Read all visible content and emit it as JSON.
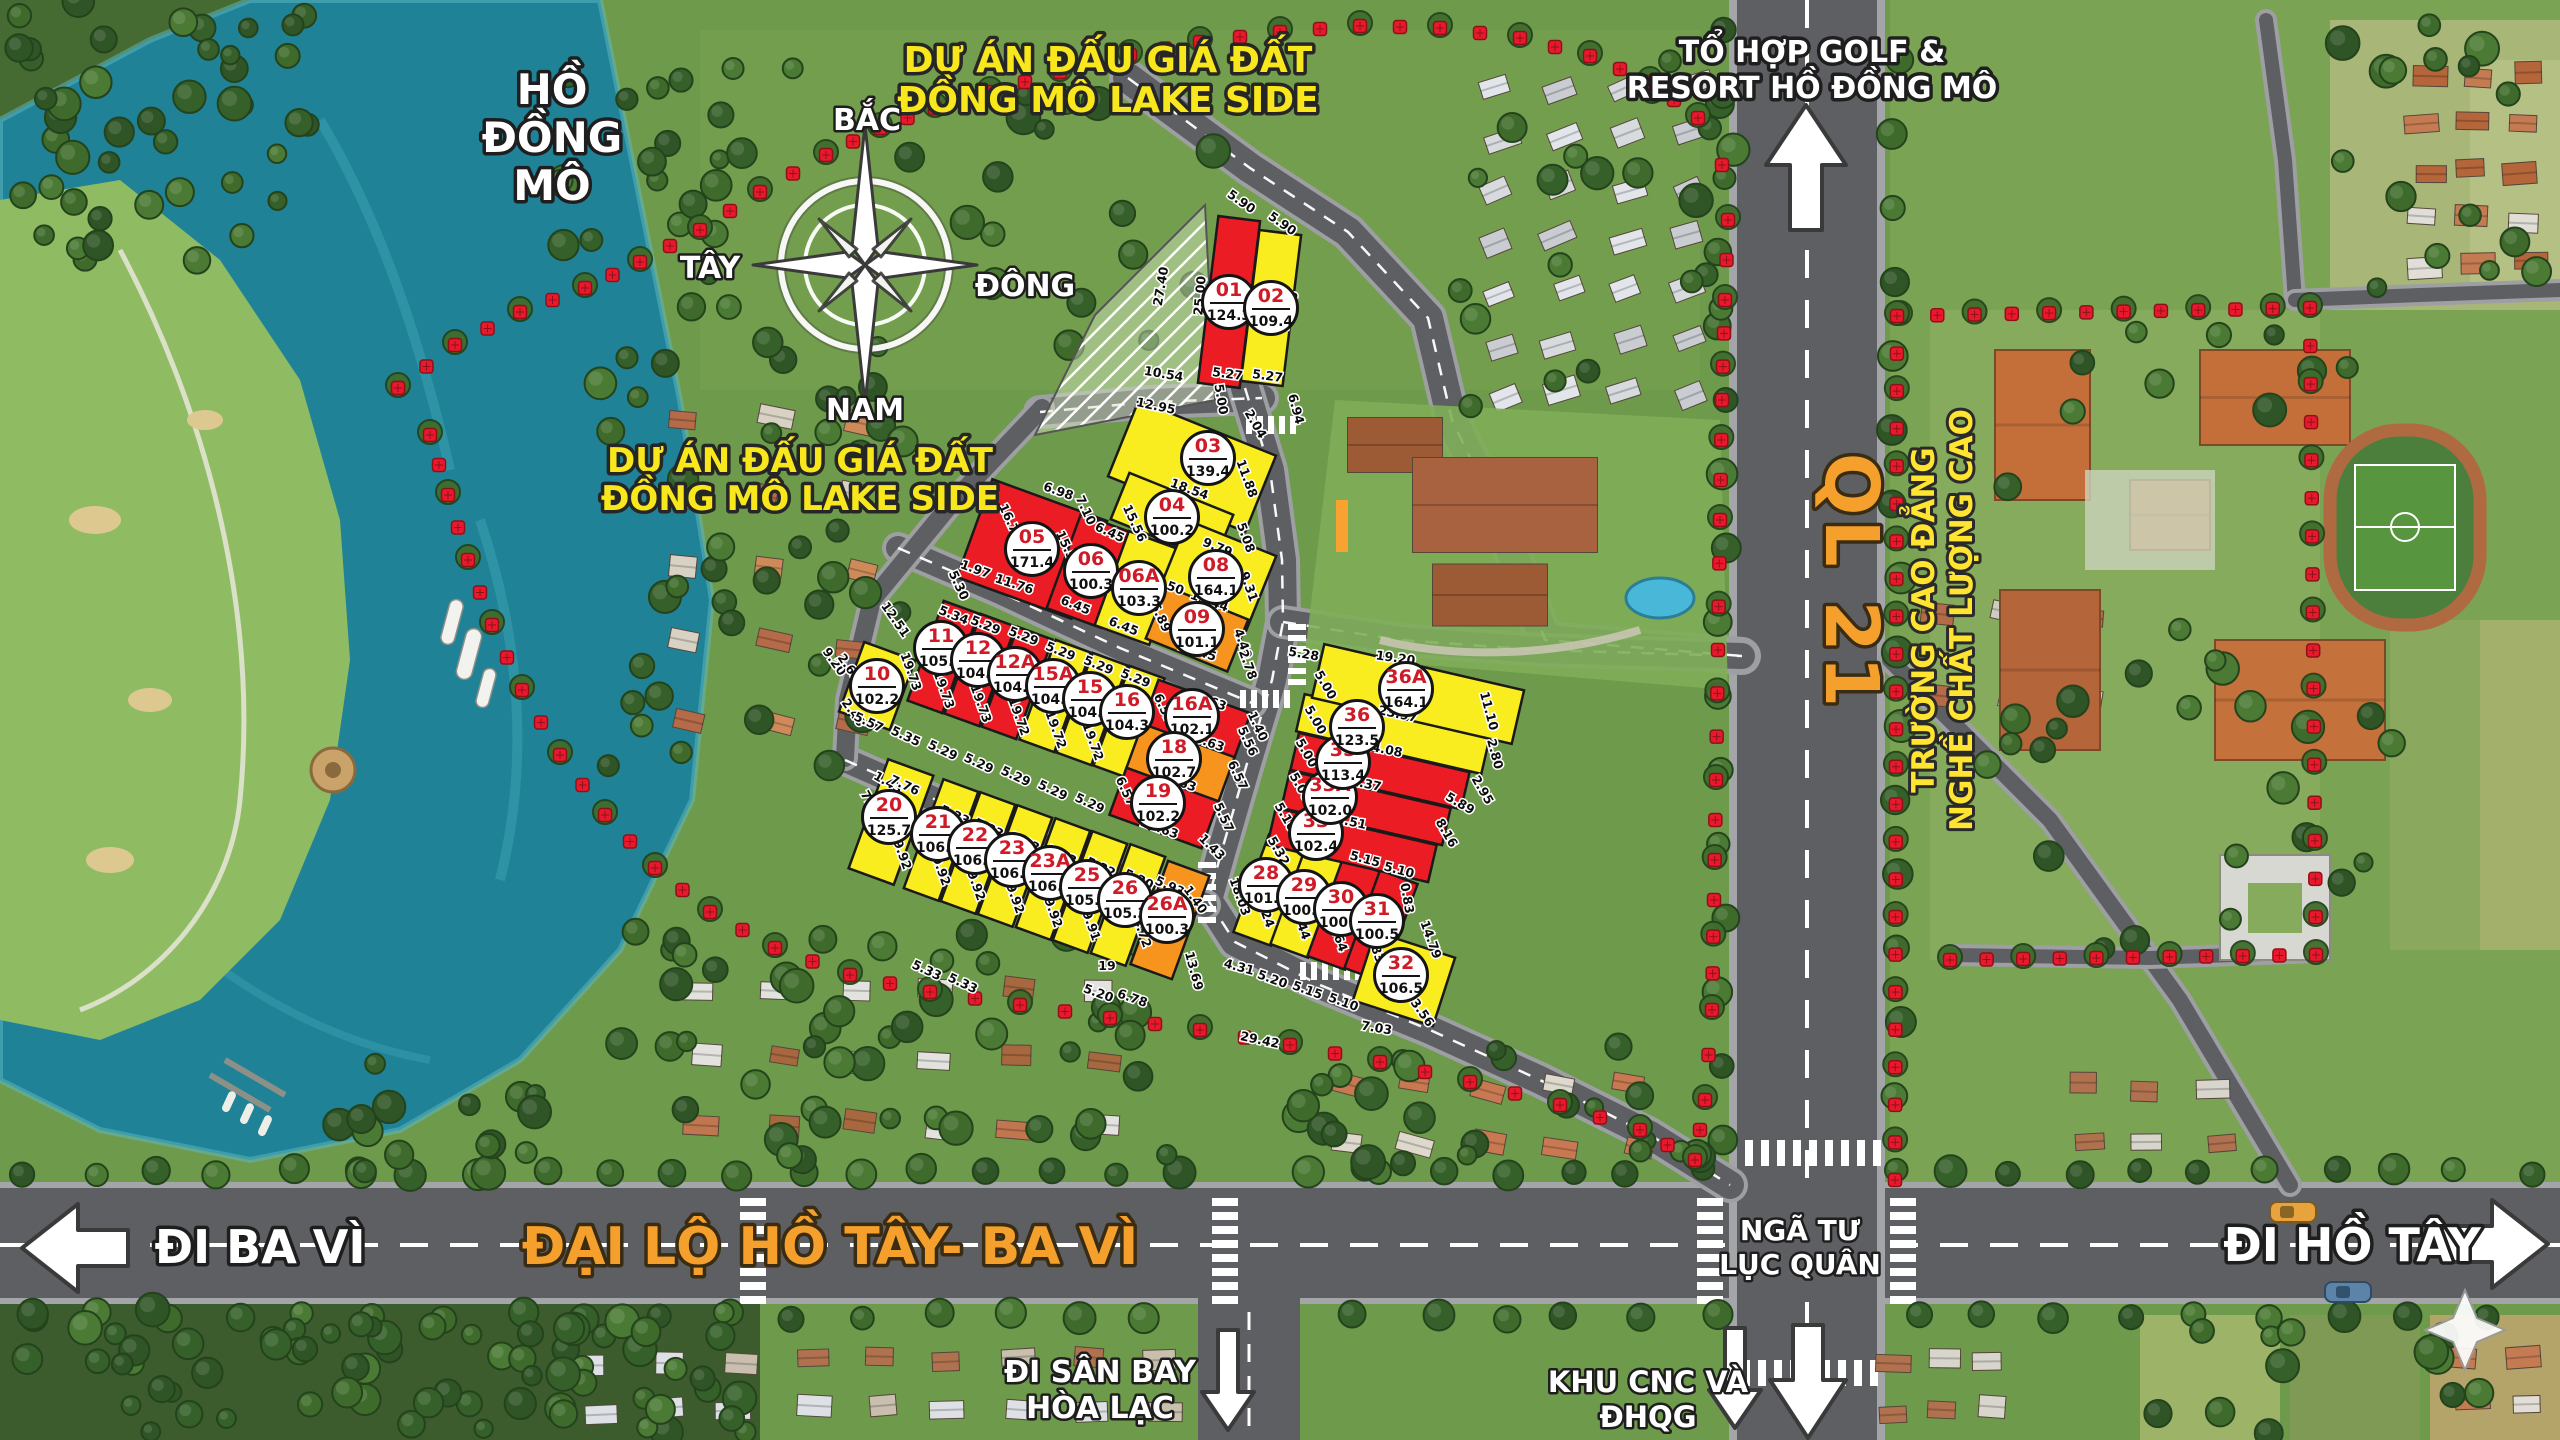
{
  "map": {
    "lake_name_l1": "HỒ",
    "lake_name_l2": "ĐỒNG",
    "lake_name_l3": "MÔ",
    "project_boundary_label_top_l1": "DỰ ÁN ĐẤU GIÁ ĐẤT",
    "project_boundary_label_top_l2": "ĐỒNG MÔ LAKE SIDE",
    "project_boundary_label_left_l1": "DỰ ÁN ĐẤU GIÁ ĐẤT",
    "project_boundary_label_left_l2": "ĐỒNG MÔ LAKE SIDE",
    "golf_resort_l1": "TỔ HỢP GOLF &",
    "golf_resort_l2": "RESORT HỒ ĐỒNG MÔ",
    "highway_name": "QL 21",
    "college_l1": "TRƯỜNG CAO ĐẲNG",
    "college_l2": "NGHỀ CHẤT LƯỢNG CAO",
    "avenue_name": "ĐẠI LỘ HỒ TÂY- BA VÌ",
    "dir_west": "ĐI BA VÌ",
    "dir_east": "ĐI HỒ TÂY",
    "junction_l1": "NGÃ TƯ",
    "junction_l2": "LỤC QUÂN",
    "dir_airport_l1": "ĐI SÂN BAY",
    "dir_airport_l2": "HÒA LẠC",
    "dir_tech_l1": "KHU CNC VÀ",
    "dir_tech_l2": "ĐHQG",
    "compass": {
      "north": "BẮC",
      "south": "NAM",
      "west": "TÂY",
      "east": "ĐÔNG"
    }
  },
  "colors": {
    "plot_yellow": "#f9ec1f",
    "plot_red": "#ec1c24",
    "plot_orange": "#f7941e",
    "boundary_red": "#e8192c",
    "avenue_label_orange": "#f5a02c",
    "project_label_yellow": "#f8e71c",
    "college_label_yellow": "#ffe431",
    "highway_label_orange": "#f2a13d"
  },
  "plots": [
    {
      "id": "01",
      "area": "124.3",
      "status": "red",
      "x": 1229,
      "y": 302,
      "w": 42,
      "h": 168,
      "rot": 7
    },
    {
      "id": "02",
      "area": "109.4",
      "status": "yellow",
      "x": 1271,
      "y": 308,
      "w": 42,
      "h": 152,
      "rot": 7
    },
    {
      "id": "03",
      "area": "139.4",
      "status": "yellow",
      "x": 1192,
      "y": 466,
      "w": 148,
      "h": 82,
      "rot": 22,
      "lx": 1208,
      "ly": 458
    },
    {
      "id": "04",
      "area": "100.2",
      "status": "yellow",
      "x": 1172,
      "y": 517,
      "w": 112,
      "h": 50,
      "rot": 22
    },
    {
      "id": "05",
      "area": "171.4",
      "status": "red",
      "x": 1032,
      "y": 549,
      "w": 122,
      "h": 104,
      "rot": 20
    },
    {
      "id": "06",
      "area": "100.3",
      "status": "red",
      "x": 1091,
      "y": 571,
      "w": 58,
      "h": 100,
      "rot": 20
    },
    {
      "id": "06A",
      "area": "103.3",
      "status": "yellow",
      "x": 1139,
      "y": 588,
      "w": 58,
      "h": 100,
      "rot": 20
    },
    {
      "id": "08",
      "area": "164.1",
      "status": "yellow",
      "x": 1216,
      "y": 577,
      "w": 96,
      "h": 84,
      "rot": 22
    },
    {
      "id": "09",
      "area": "101.1",
      "status": "orange",
      "x": 1197,
      "y": 629,
      "w": 88,
      "h": 56,
      "rot": 22
    },
    {
      "id": "10",
      "area": "102.2",
      "status": "yellow",
      "x": 877,
      "y": 686,
      "w": 54,
      "h": 74,
      "rot": 20
    },
    {
      "id": "11",
      "area": "105.5",
      "status": "red",
      "x": 943,
      "y": 657,
      "w": 37,
      "h": 106,
      "rot": 20,
      "lx": 941,
      "ly": 648
    },
    {
      "id": "12",
      "area": "104.4",
      "status": "red",
      "x": 980,
      "y": 670,
      "w": 37,
      "h": 106,
      "rot": 20,
      "lx": 978,
      "ly": 660
    },
    {
      "id": "12A",
      "area": "104.4",
      "status": "red",
      "x": 1017,
      "y": 683,
      "w": 37,
      "h": 106,
      "rot": 20,
      "lx": 1015,
      "ly": 674
    },
    {
      "id": "15A",
      "area": "104.3",
      "status": "yellow",
      "x": 1055,
      "y": 696,
      "w": 37,
      "h": 106,
      "rot": 20,
      "lx": 1053,
      "ly": 686
    },
    {
      "id": "15",
      "area": "104.3",
      "status": "yellow",
      "x": 1092,
      "y": 709,
      "w": 37,
      "h": 106,
      "rot": 20,
      "lx": 1090,
      "ly": 699
    },
    {
      "id": "16",
      "area": "104.3",
      "status": "yellow",
      "x": 1129,
      "y": 722,
      "w": 37,
      "h": 106,
      "rot": 20,
      "lx": 1127,
      "ly": 712
    },
    {
      "id": "16A",
      "area": "102.1",
      "status": "red",
      "x": 1196,
      "y": 720,
      "w": 98,
      "h": 50,
      "rot": 20,
      "lx": 1192,
      "ly": 716
    },
    {
      "id": "18",
      "area": "102.7",
      "status": "orange",
      "x": 1180,
      "y": 764,
      "w": 98,
      "h": 50,
      "rot": 20,
      "lx": 1174,
      "ly": 759
    },
    {
      "id": "19",
      "area": "102.2",
      "status": "red",
      "x": 1164,
      "y": 808,
      "w": 98,
      "h": 50,
      "rot": 20,
      "lx": 1158,
      "ly": 803
    },
    {
      "id": "20",
      "area": "125.7",
      "status": "yellow",
      "x": 891,
      "y": 822,
      "w": 48,
      "h": 116,
      "rot": 20,
      "lx": 889,
      "ly": 817
    },
    {
      "id": "21",
      "area": "106.1",
      "status": "yellow",
      "x": 941,
      "y": 840,
      "w": 37,
      "h": 116,
      "rot": 20,
      "lx": 938,
      "ly": 834
    },
    {
      "id": "22",
      "area": "106.1",
      "status": "yellow",
      "x": 978,
      "y": 853,
      "w": 37,
      "h": 116,
      "rot": 20,
      "lx": 975,
      "ly": 847
    },
    {
      "id": "23",
      "area": "106.1",
      "status": "yellow",
      "x": 1015,
      "y": 866,
      "w": 37,
      "h": 116,
      "rot": 20,
      "lx": 1012,
      "ly": 860
    },
    {
      "id": "23A",
      "area": "106.1",
      "status": "yellow",
      "x": 1053,
      "y": 879,
      "w": 37,
      "h": 116,
      "rot": 20,
      "lx": 1050,
      "ly": 873
    },
    {
      "id": "25",
      "area": "105.9",
      "status": "yellow",
      "x": 1090,
      "y": 892,
      "w": 37,
      "h": 116,
      "rot": 20,
      "lx": 1087,
      "ly": 887
    },
    {
      "id": "26",
      "area": "105.3",
      "status": "yellow",
      "x": 1128,
      "y": 905,
      "w": 37,
      "h": 116,
      "rot": 20,
      "lx": 1125,
      "ly": 900
    },
    {
      "id": "26A",
      "area": "100.3",
      "status": "orange",
      "x": 1170,
      "y": 920,
      "w": 44,
      "h": 110,
      "rot": 20,
      "lx": 1167,
      "ly": 916
    },
    {
      "id": "28",
      "area": "101.1",
      "status": "yellow",
      "x": 1270,
      "y": 890,
      "w": 40,
      "h": 104,
      "rot": 20,
      "lx": 1266,
      "ly": 885
    },
    {
      "id": "29",
      "area": "100.5",
      "status": "yellow",
      "x": 1307,
      "y": 902,
      "w": 40,
      "h": 104,
      "rot": 20,
      "lx": 1304,
      "ly": 897
    },
    {
      "id": "30",
      "area": "100.5",
      "status": "red",
      "x": 1344,
      "y": 914,
      "w": 40,
      "h": 104,
      "rot": 20,
      "lx": 1341,
      "ly": 909
    },
    {
      "id": "31",
      "area": "100.5",
      "status": "red",
      "x": 1381,
      "y": 926,
      "w": 40,
      "h": 104,
      "rot": 20,
      "lx": 1377,
      "ly": 921
    },
    {
      "id": "32",
      "area": "106.5",
      "status": "yellow",
      "x": 1404,
      "y": 979,
      "w": 84,
      "h": 72,
      "rot": 18,
      "lx": 1401,
      "ly": 975
    },
    {
      "id": "33",
      "area": "102.4",
      "status": "red",
      "x": 1352,
      "y": 845,
      "w": 165,
      "h": 38,
      "rot": 13,
      "lx": 1316,
      "ly": 833
    },
    {
      "id": "33A",
      "area": "102.0",
      "status": "red",
      "x": 1366,
      "y": 808,
      "w": 165,
      "h": 38,
      "rot": 13,
      "lx": 1330,
      "ly": 797
    },
    {
      "id": "35",
      "area": "113.4",
      "status": "red",
      "x": 1380,
      "y": 771,
      "w": 175,
      "h": 38,
      "rot": 13,
      "lx": 1343,
      "ly": 762
    },
    {
      "id": "36",
      "area": "123.5",
      "status": "yellow",
      "x": 1393,
      "y": 734,
      "w": 190,
      "h": 38,
      "rot": 13,
      "lx": 1357,
      "ly": 727
    },
    {
      "id": "36A",
      "area": "164.1",
      "status": "yellow",
      "x": 1418,
      "y": 694,
      "w": 205,
      "h": 55,
      "rot": 13,
      "lx": 1406,
      "ly": 689
    }
  ],
  "dimensions": [
    [
      "5.90",
      1239,
      205,
      35
    ],
    [
      "5.90",
      1280,
      227,
      35
    ],
    [
      "27.40",
      1165,
      287,
      -80
    ],
    [
      "25.00",
      1204,
      296,
      -85
    ],
    [
      "22.18",
      1243,
      303,
      -85
    ],
    [
      "19.36",
      1293,
      312,
      -75
    ],
    [
      "5.27",
      1227,
      378,
      8
    ],
    [
      "5.27",
      1267,
      380,
      8
    ],
    [
      "10.54",
      1163,
      378,
      10
    ],
    [
      "12.95",
      1155,
      410,
      12
    ],
    [
      "5.00",
      1217,
      400,
      80
    ],
    [
      "2.04",
      1252,
      426,
      60
    ],
    [
      "6.94",
      1292,
      410,
      75
    ],
    [
      "11.88",
      1243,
      480,
      70
    ],
    [
      "18.54",
      1188,
      493,
      20
    ],
    [
      "6.45",
      1159,
      518,
      25
    ],
    [
      "6.45",
      1108,
      536,
      25
    ],
    [
      "9.79",
      1216,
      551,
      22
    ],
    [
      "5.08",
      1242,
      539,
      70
    ],
    [
      "8.67",
      1206,
      570,
      60
    ],
    [
      "15.56",
      1131,
      525,
      65
    ],
    [
      "15.56",
      1064,
      551,
      65
    ],
    [
      "50",
      1174,
      592,
      20
    ],
    [
      "13.44",
      1208,
      605,
      20
    ],
    [
      "6.89",
      1157,
      619,
      65
    ],
    [
      "6.45",
      1122,
      630,
      22
    ],
    [
      "6.45",
      1074,
      609,
      22
    ],
    [
      "15.45",
      1196,
      655,
      18
    ],
    [
      "4.40",
      1239,
      645,
      70
    ],
    [
      "9.31",
      1245,
      588,
      70
    ],
    [
      "2.78",
      1244,
      666,
      70
    ],
    [
      "6.98",
      1057,
      495,
      20
    ],
    [
      "7.10",
      1082,
      512,
      65
    ],
    [
      "16.73",
      1007,
      524,
      65
    ],
    [
      "1.97",
      974,
      573,
      20
    ],
    [
      "11.76",
      1013,
      588,
      18
    ],
    [
      "5.30",
      955,
      587,
      65
    ],
    [
      "12.51",
      892,
      622,
      55
    ],
    [
      "5.34",
      952,
      619,
      22
    ],
    [
      "5.29",
      984,
      629,
      22
    ],
    [
      "5.29",
      1022,
      640,
      22
    ],
    [
      "5.29",
      1059,
      655,
      22
    ],
    [
      "5.29",
      1097,
      669,
      22
    ],
    [
      "5.29",
      1134,
      682,
      22
    ],
    [
      "9.20",
      831,
      664,
      55
    ],
    [
      "2.63",
      846,
      670,
      55
    ],
    [
      "19.73",
      907,
      673,
      70
    ],
    [
      "19.73",
      940,
      691,
      70
    ],
    [
      "19.73",
      977,
      705,
      70
    ],
    [
      "19.72",
      1015,
      718,
      70
    ],
    [
      "19.72",
      1052,
      731,
      70
    ],
    [
      "19.72",
      1089,
      743,
      70
    ],
    [
      "2.40",
      850,
      715,
      55
    ],
    [
      "5.57",
      867,
      726,
      25
    ],
    [
      "5.35",
      904,
      740,
      25
    ],
    [
      "5.29",
      941,
      754,
      25
    ],
    [
      "5.29",
      977,
      767,
      25
    ],
    [
      "5.29",
      1014,
      780,
      25
    ],
    [
      "5.29",
      1051,
      794,
      25
    ],
    [
      "5.29",
      1088,
      807,
      25
    ],
    [
      "14.63",
      1206,
      704,
      20
    ],
    [
      "1.40",
      1254,
      728,
      65
    ],
    [
      "5.56",
      1244,
      743,
      65
    ],
    [
      "15.63",
      1204,
      745,
      20
    ],
    [
      "6.57",
      1160,
      710,
      65
    ],
    [
      "6.57",
      1234,
      777,
      65
    ],
    [
      "15.63",
      1176,
      785,
      20
    ],
    [
      "6.57",
      1122,
      793,
      65
    ],
    [
      "14.63",
      1158,
      832,
      20
    ],
    [
      "5.57",
      1220,
      819,
      65
    ],
    [
      "1.43",
      1209,
      850,
      45
    ],
    [
      "1.43",
      886,
      786,
      30
    ],
    [
      "7.76",
      903,
      789,
      25
    ],
    [
      "7.95",
      868,
      807,
      60
    ],
    [
      "5.33",
      953,
      819,
      25
    ],
    [
      "5.33",
      987,
      832,
      25
    ],
    [
      "5.33",
      1023,
      846,
      25
    ],
    [
      "5.33",
      1060,
      859,
      25
    ],
    [
      "5.32",
      1099,
      871,
      25
    ],
    [
      "5.20",
      1137,
      883,
      25
    ],
    [
      "19.92",
      897,
      852,
      70
    ],
    [
      "19.92",
      936,
      868,
      70
    ],
    [
      "19.92",
      971,
      883,
      70
    ],
    [
      "19.92",
      1010,
      896,
      70
    ],
    [
      "19.92",
      1048,
      910,
      70
    ],
    [
      "19.91",
      1086,
      923,
      70
    ],
    [
      "14.72",
      1137,
      930,
      70
    ],
    [
      "5.93",
      1168,
      890,
      25
    ],
    [
      "1.40",
      1192,
      902,
      55
    ],
    [
      "18.03",
      1236,
      898,
      70
    ],
    [
      "19.24",
      1260,
      910,
      70
    ],
    [
      "19.44",
      1296,
      922,
      70
    ],
    [
      "19.64",
      1333,
      934,
      70
    ],
    [
      "19.83",
      1370,
      945,
      70
    ],
    [
      "13.69",
      1190,
      972,
      75
    ],
    [
      "4.31",
      1238,
      971,
      15
    ],
    [
      "5.20",
      1271,
      983,
      20
    ],
    [
      "5.15",
      1306,
      994,
      20
    ],
    [
      "5.10",
      1342,
      1006,
      20
    ],
    [
      "7.03",
      1376,
      1032,
      10
    ],
    [
      "3.56",
      1419,
      1015,
      55
    ],
    [
      "29.42",
      1259,
      1044,
      12
    ],
    [
      "6.78",
      1131,
      1002,
      20
    ],
    [
      "5.20",
      1097,
      997,
      20
    ],
    [
      "5.33",
      925,
      974,
      25
    ],
    [
      "5.33",
      961,
      987,
      25
    ],
    [
      "19",
      1107,
      970,
      0
    ],
    [
      "5.28",
      1303,
      658,
      10
    ],
    [
      "19.20",
      1395,
      662,
      8
    ],
    [
      "5.00",
      1322,
      687,
      60
    ],
    [
      "23.97",
      1397,
      718,
      12
    ],
    [
      "24.08",
      1382,
      753,
      12
    ],
    [
      "21.37",
      1361,
      787,
      12
    ],
    [
      "18.51",
      1346,
      825,
      12
    ],
    [
      "5.15",
      1364,
      863,
      15
    ],
    [
      "5.10",
      1398,
      874,
      15
    ],
    [
      "5.00",
      1312,
      722,
      60
    ],
    [
      "5.00",
      1303,
      755,
      60
    ],
    [
      "5.00",
      1297,
      789,
      60
    ],
    [
      "5.10",
      1282,
      819,
      60
    ],
    [
      "5.32",
      1275,
      853,
      60
    ],
    [
      "11.10",
      1485,
      712,
      75
    ],
    [
      "2.80",
      1491,
      755,
      75
    ],
    [
      "2.95",
      1479,
      792,
      60
    ],
    [
      "5.89",
      1458,
      807,
      30
    ],
    [
      "8.16",
      1443,
      835,
      60
    ],
    [
      "0.83",
      1403,
      899,
      80
    ],
    [
      "14.79",
      1427,
      941,
      70
    ]
  ]
}
